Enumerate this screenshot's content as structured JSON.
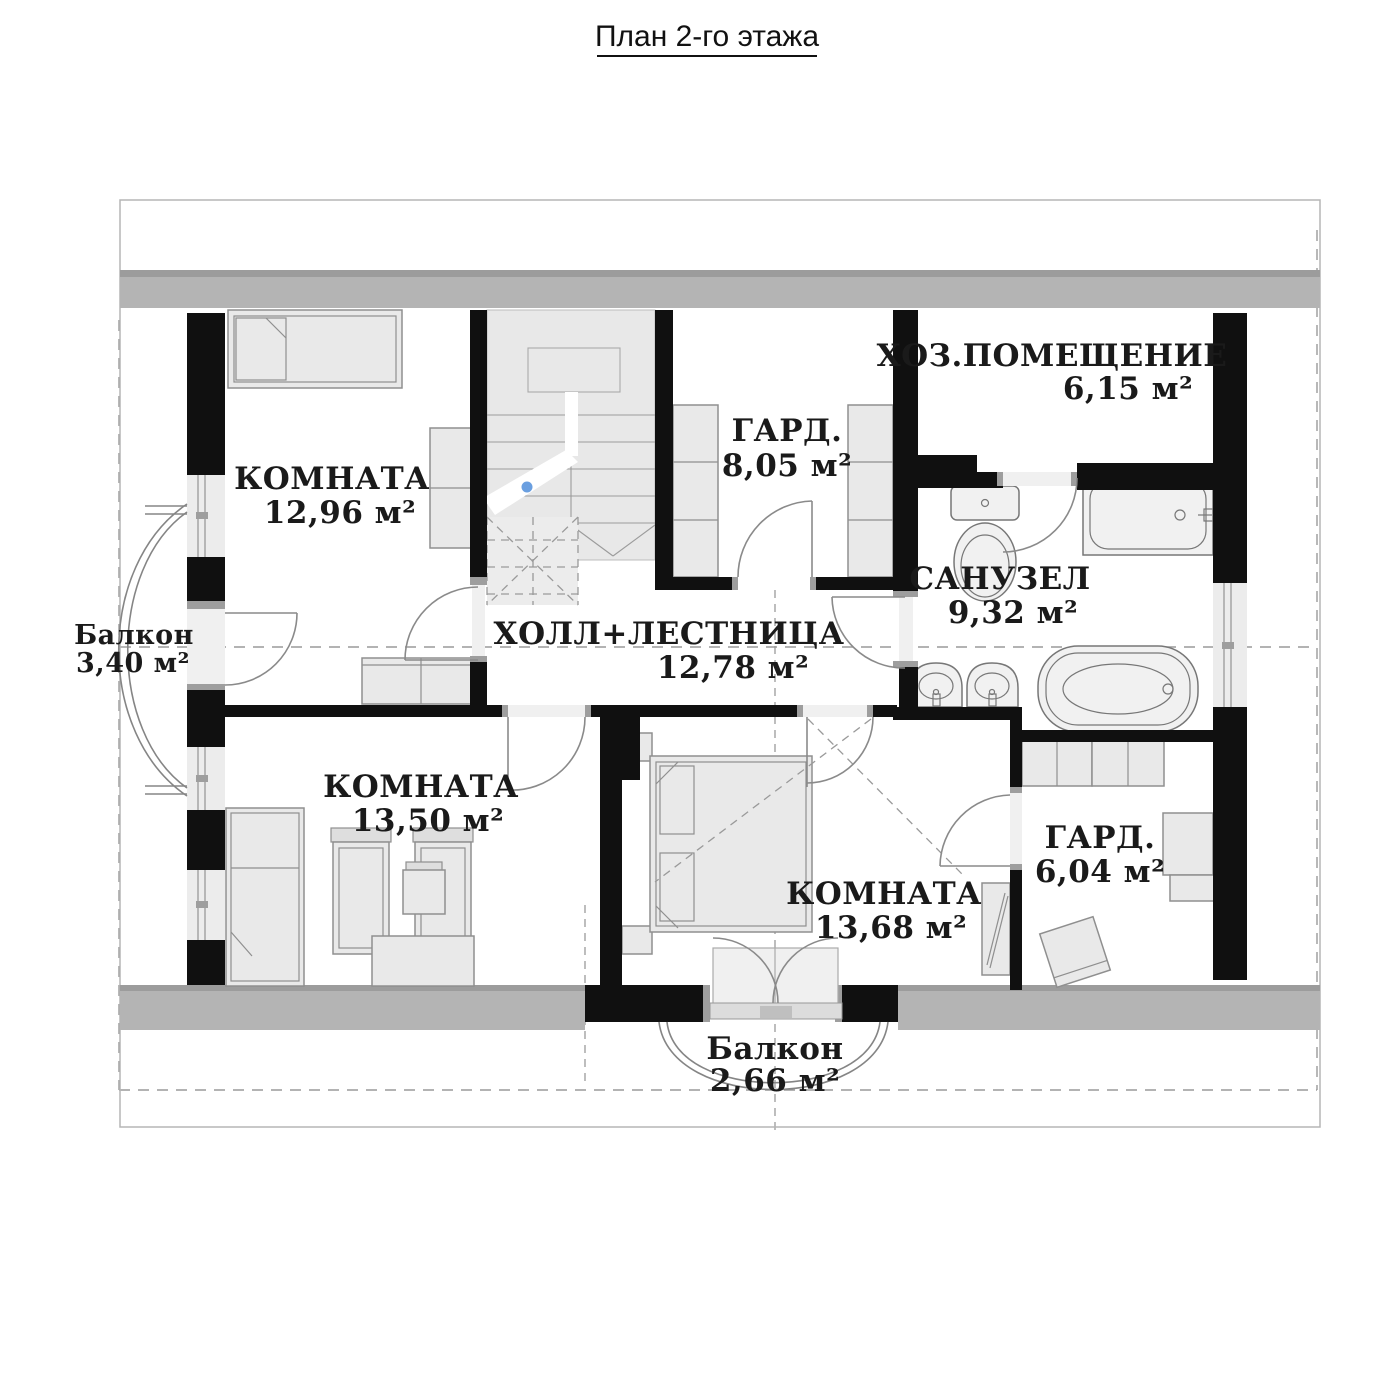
{
  "title": "План 2-го этажа",
  "rooms": {
    "room_top_left": {
      "name": "КОМНАТА",
      "area": "12,96 м²"
    },
    "hall": {
      "name": "ХОЛЛ+ЛЕСТНИЦА",
      "area": "12,78 м²"
    },
    "wardrobe_top": {
      "name": "ГАРД.",
      "area": "8,05 м²"
    },
    "utility": {
      "name": "ХОЗ.ПОМЕЩЕНИЕ",
      "area": "6,15 м²"
    },
    "bathroom": {
      "name": "САНУЗЕЛ",
      "area": "9,32 м²"
    },
    "room_bottom_left": {
      "name": "КОМНАТА",
      "area": "13,50 м²"
    },
    "room_bottom_center": {
      "name": "КОМНАТА",
      "area": "13,68 м²"
    },
    "wardrobe_bottom": {
      "name": "ГАРД.",
      "area": "6,04 м²"
    },
    "balcony_left": {
      "name": "Балкон",
      "area": "3,40 м²"
    },
    "balcony_bottom": {
      "name": "Балкон",
      "area": "2,66 м²"
    }
  },
  "colors": {
    "wall": "#101010",
    "exterior_band": "#b4b4b4",
    "furniture": "#e9e9e9",
    "stair_marker_dot": "#6a9fe0",
    "dashed_guides": "#9a9a9a",
    "background": "#ffffff"
  }
}
